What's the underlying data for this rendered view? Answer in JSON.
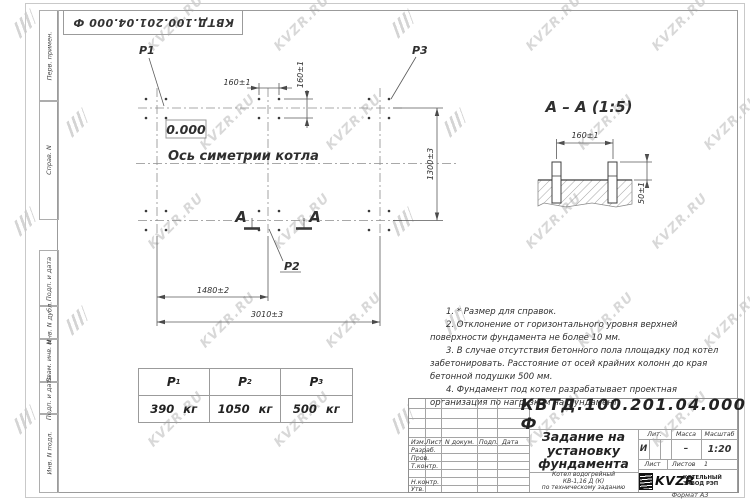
{
  "watermark": {
    "text": "KVZR.RU"
  },
  "sheet": {
    "top_stamp": "КВТД.100.201.04.000 Ф",
    "format_note": "Формат А3",
    "side_labels": [
      "Перв. примен.",
      "Справ. N",
      "Подп. и дата",
      "Инв. N дубл.",
      "Взам. инв. N",
      "Подп. и дата",
      "Инв. N подл."
    ]
  },
  "plan": {
    "load_p1": "Р1",
    "load_p2": "Р2",
    "load_p3": "Р3",
    "elevation": "0.000",
    "axis_label": "Ось симетрии котла",
    "section_letter_left": "А",
    "section_letter_right": "А",
    "dim_bolt_spacing_h": "160±1",
    "dim_bolt_spacing_v": "160±1",
    "dim_width": "1300±3",
    "dim_left_span": "1480±2",
    "dim_total_span": "3010±3"
  },
  "section": {
    "title": "А – А (1:5)",
    "dim_spacing": "160±1",
    "dim_height": "50±1"
  },
  "notes": [
    "1. * Размер для справок.",
    "2. Отклонение от горизонтального уровня верхней поверхности фундамента не более 10 мм.",
    "3. В случае отсутствия бетонного пола площадку под котел забетонировать. Расстояние от осей крайних колонн до края бетонной подушки 500 мм.",
    "4. Фундамент под котел разрабатывает проектная организация по нагрузкам на фундамент."
  ],
  "loads_table": {
    "columns": [
      {
        "symbol": "Р",
        "index": "1",
        "value": "390 кг"
      },
      {
        "symbol": "Р",
        "index": "2",
        "value": "1050 кг"
      },
      {
        "symbol": "Р",
        "index": "3",
        "value": "500 кг"
      }
    ]
  },
  "title_block": {
    "designation": "КВТД.100.201.04.000 Ф",
    "doc_title_lines": [
      "Задание на",
      "установку",
      "фундамента"
    ],
    "product_lines": [
      "Котел водогрейный",
      "КВ-1,16 Д (К)",
      "по техническому заданию"
    ],
    "header_cols": [
      "Изм.Лист",
      "N докум.",
      "Подп.",
      "Дата"
    ],
    "row_labels": [
      "Разраб.",
      "Пров.",
      "Т.контр.",
      "",
      "Н.контр.",
      "Утв."
    ],
    "lit_label": "Лит.",
    "mass_label": "Масса",
    "scale_label": "Масштаб",
    "lit_value": "И",
    "mass_value": "–",
    "scale_value": "1:20",
    "sheet_label": "Лист",
    "sheets_label": "Листов",
    "sheets_value": "1",
    "brand": "KVZR",
    "brand_caption_lines": [
      "КОТЕЛЬНЫЙ",
      "ЗАВОД РЭП"
    ]
  }
}
